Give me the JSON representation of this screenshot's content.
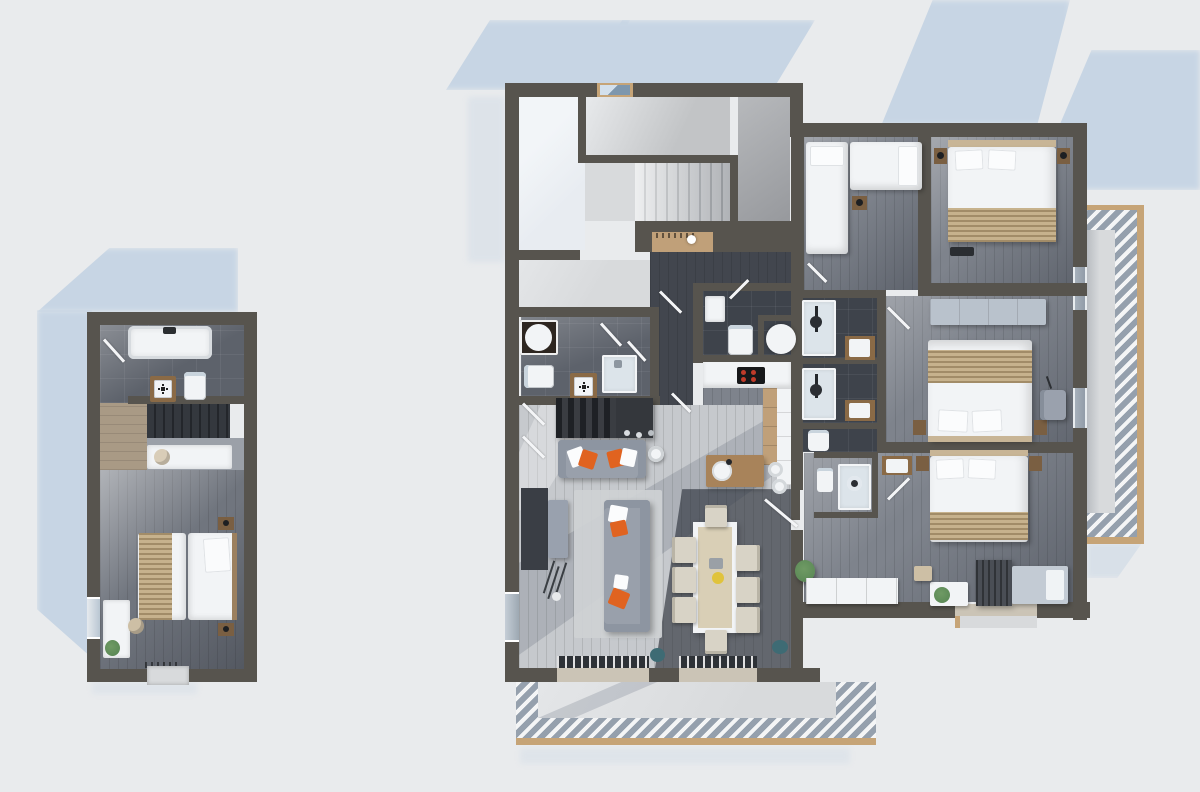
{
  "meta": {
    "type": "3d-floor-plan-render",
    "view": "top-down",
    "description": "Top-down 3D architectural floor plan render of a chalet apartment: large main unit with staircase, kitchen, living-dining room, four bedrooms, en-suite shower rooms, right-side balcony and bottom terrace, plus a separate small annex unit with bathroom, stairs and twin bedroom"
  },
  "palette": {
    "bg": "#e9ebed",
    "shadow": "#c7d5e4",
    "wall": "#57544e",
    "floorLight": "#c6c9cd",
    "floorGray": "#7e838c",
    "floorGrayDark": "#70757e",
    "floorDark": "#42464e",
    "tile": "#5d626b",
    "tileDark": "#3e434b",
    "stair": "#d8dadc",
    "landing": "#c2c4c6",
    "voidRoom": "#e8ecf1",
    "white": "#f2f4f6",
    "woodTan": "#c0a079",
    "woodMid": "#8a6a46",
    "woodDark": "#7a5f42",
    "woodFloor": "#a99a85",
    "throw": "#c7b28d",
    "sofa": "#99a0ab",
    "sofaDark": "#8d95a1",
    "rug": "#ced1d4",
    "orange": "#e06320",
    "teal": "#3e6b74",
    "green": "#5c8a57",
    "tableWood": "#d9cfb6",
    "chairBeige": "#d8d3c6",
    "shower": "#dce4ea",
    "glass": "#b9cbda",
    "frame": "#c6a477",
    "hatchA": "#f4f5f6",
    "hatchB": "#95a0ad",
    "cooktop": "#17181a",
    "red": "#c03b2a",
    "yellow": "#e0c33c",
    "curtain": "#4a4e55",
    "daybed": "#c3cbd4",
    "benchBlue": "#b9c2cc",
    "console": "#34373c",
    "hearth": "#3a3e45",
    "charcoal": "#2a2d31",
    "concrete": "#d8dadc",
    "threshold": "#cbc4b6"
  },
  "units": [
    {
      "id": "annex",
      "rooms": [
        {
          "name": "bathroom",
          "furniture": [
            "bathtub",
            "toilet",
            "vanity-sink",
            "door"
          ]
        },
        {
          "name": "staircase",
          "furniture": [
            "stairs",
            "desk",
            "chair"
          ]
        },
        {
          "name": "bedroom",
          "furniture": [
            "twin-beds",
            "throw-blanket",
            "nightstand",
            "nightstand",
            "desk",
            "chair",
            "plant",
            "entry-step",
            "window"
          ]
        }
      ]
    },
    {
      "id": "main",
      "rooms": [
        {
          "name": "stair-hall",
          "furniture": [
            "staircase",
            "landing",
            "window",
            "void"
          ]
        },
        {
          "name": "entry",
          "furniture": [
            "wardrobe-niche",
            "doors"
          ]
        },
        {
          "name": "bathroom-1",
          "furniture": [
            "round-basin",
            "toilet",
            "vanity-sink",
            "shower"
          ]
        },
        {
          "name": "wc",
          "furniture": [
            "toilet",
            "cabinet",
            "round-basin"
          ]
        },
        {
          "name": "shower-room-1",
          "furniture": [
            "shower",
            "vanity-sink"
          ]
        },
        {
          "name": "shower-room-2",
          "furniture": [
            "shower",
            "vanity-sink"
          ]
        },
        {
          "name": "wc-2",
          "furniture": [
            "toilet"
          ]
        },
        {
          "name": "shower-room-3",
          "furniture": [
            "shower",
            "toilet",
            "vanity-sink"
          ]
        },
        {
          "name": "kitchen",
          "furniture": [
            "counter",
            "induction-cooktop",
            "tall-units",
            "island-with-sink",
            "bar-stools"
          ]
        },
        {
          "name": "living-dining",
          "furniture": [
            "media-console",
            "sofa",
            "sofa",
            "rug",
            "side-table",
            "tv-cabinet",
            "floor-lamp",
            "dining-table",
            "eight-chairs",
            "plants",
            "stools",
            "folding-glass-doors"
          ]
        },
        {
          "name": "bedroom-1",
          "furniture": [
            "single-bed",
            "single-bed",
            "nightstand"
          ]
        },
        {
          "name": "bedroom-2",
          "furniture": [
            "double-bed",
            "throw-blanket",
            "nightstand",
            "nightstand",
            "bench"
          ]
        },
        {
          "name": "bedroom-3",
          "furniture": [
            "daybench",
            "double-bed",
            "throw-blanket",
            "nightstand",
            "nightstand",
            "armchair"
          ]
        },
        {
          "name": "bedroom-4",
          "furniture": [
            "double-bed",
            "throw-blanket",
            "nightstand",
            "nightstand",
            "curtain-wardrobe",
            "daybed",
            "plant-table",
            "bench-cabinets",
            "stool"
          ]
        },
        {
          "name": "balcony",
          "furniture": [
            "hatched-deck"
          ]
        },
        {
          "name": "terrace",
          "furniture": [
            "hatched-deck",
            "step"
          ]
        }
      ]
    }
  ]
}
